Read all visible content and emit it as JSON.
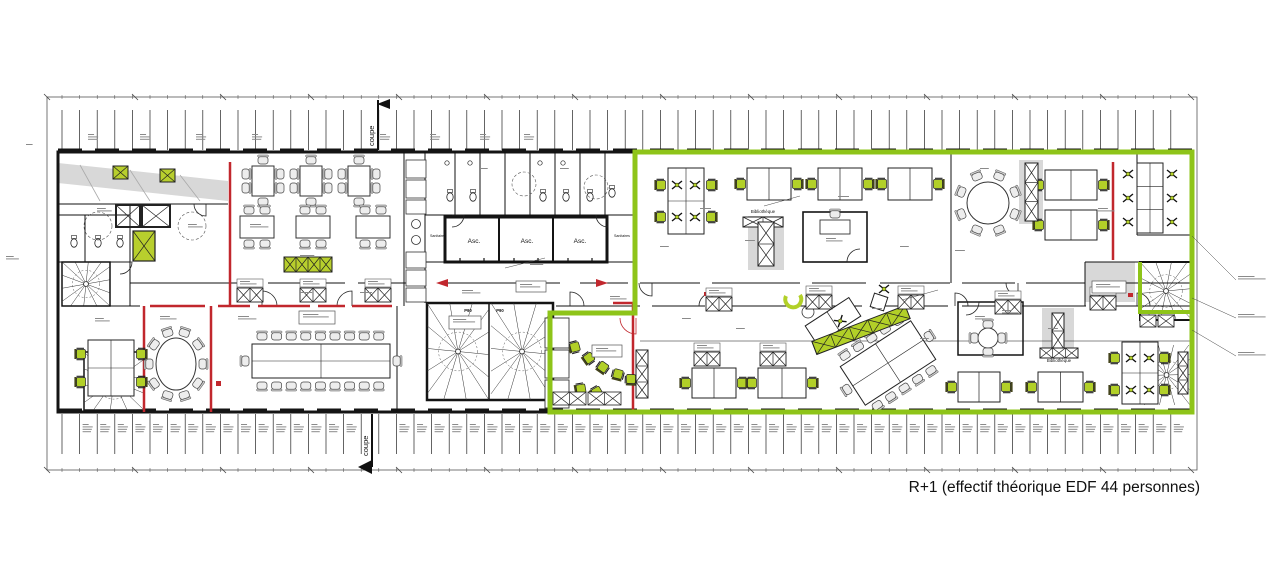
{
  "caption": "R+1 (effectif théorique EDF 44 personnes)",
  "elevators": [
    "Asc.",
    "Asc.",
    "Asc."
  ],
  "labels": {
    "elevator": "Asc.",
    "library": "Bibliothèque",
    "section": "coupe",
    "sanitary": "Sanitaires",
    "door_tag": "P90"
  },
  "colors": {
    "wall": "#141414",
    "zone_outline": "#8ec419",
    "furniture_green": "#b2d028",
    "hatch_green": "#b8cf2d",
    "alert_red": "#c1272d",
    "light_gray": "#d8d8d8"
  }
}
